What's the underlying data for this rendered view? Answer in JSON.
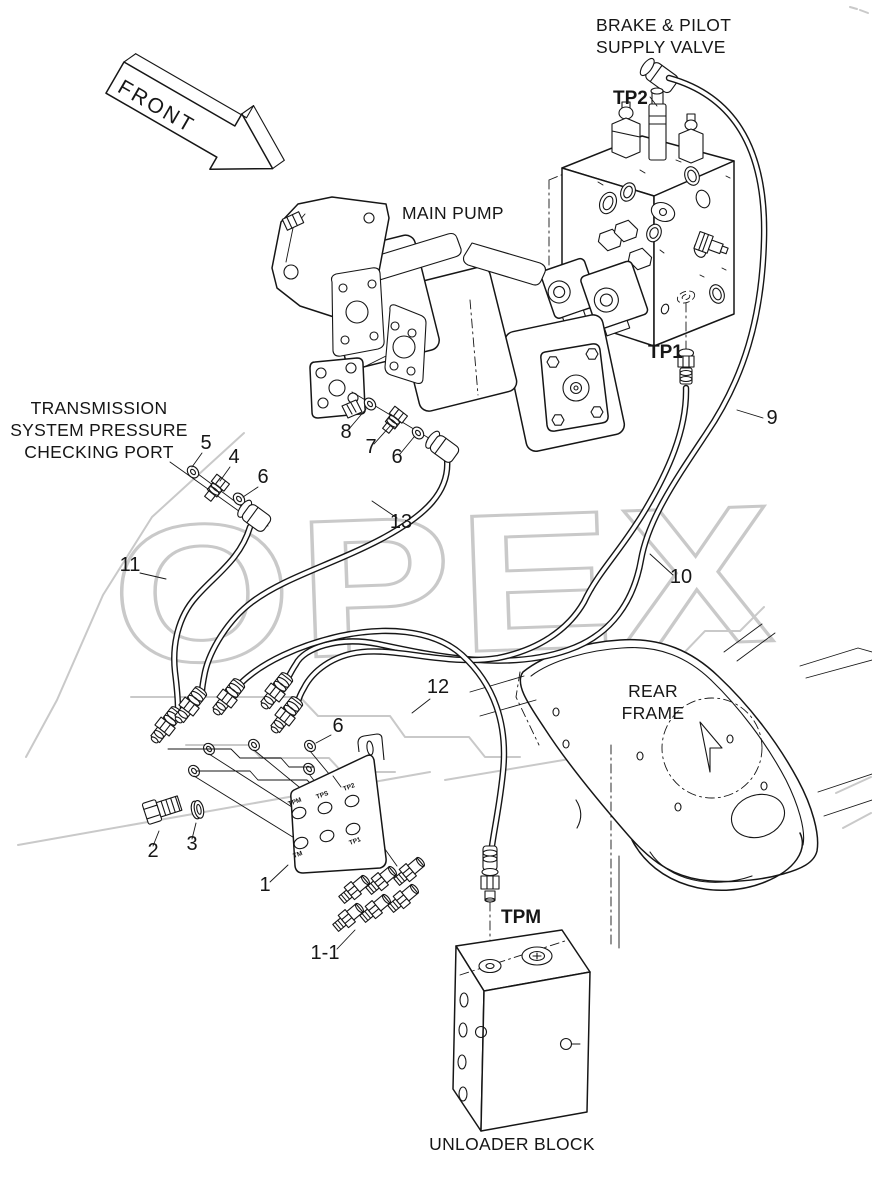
{
  "watermark": {
    "text": "OPEX",
    "color": "#c9c9c9"
  },
  "front_arrow": {
    "label": "FRONT"
  },
  "labels": {
    "brake_pilot_valve_line1": "BRAKE & PILOT",
    "brake_pilot_valve_line2": "SUPPLY VALVE",
    "main_pump": "MAIN PUMP",
    "transmission_port_line1": "TRANSMISSION",
    "transmission_port_line2": "SYSTEM PRESSURE",
    "transmission_port_line3": "CHECKING PORT",
    "rear_frame_line1": "REAR",
    "rear_frame_line2": "FRAME",
    "unloader_block": "UNLOADER BLOCK"
  },
  "test_ports": {
    "tp2": "TP2",
    "tp1": "TP1",
    "tpm": "TPM"
  },
  "bracket_ports": {
    "p1": "TPM",
    "p2": "TPS",
    "p3": "TP2",
    "p4": "TM",
    "p5": "TP1"
  },
  "callouts": {
    "n1": "1",
    "n1_1": "1-1",
    "n2": "2",
    "n3": "3",
    "n4": "4",
    "n5": "5",
    "n6": "6",
    "n7": "7",
    "n8": "8",
    "n9": "9",
    "n10": "10",
    "n11": "11",
    "n12": "12",
    "n13": "13"
  }
}
